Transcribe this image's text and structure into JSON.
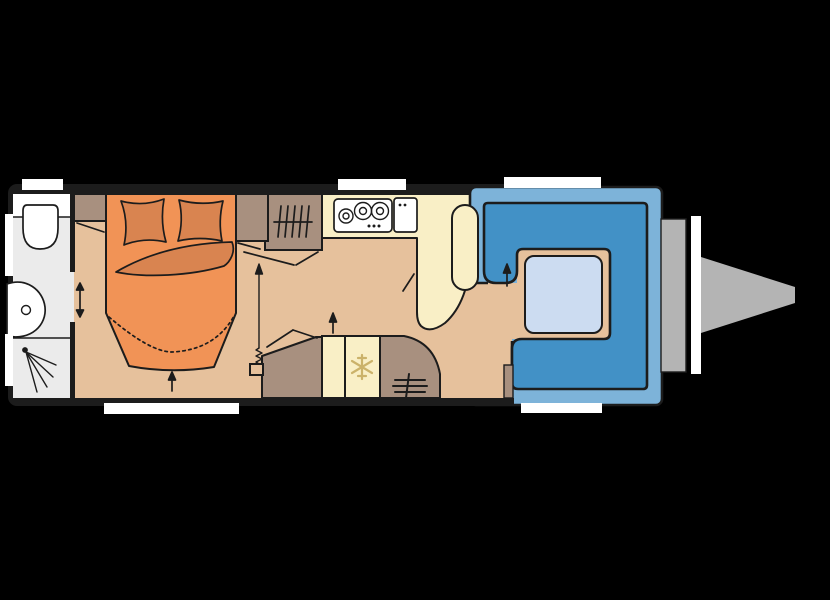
{
  "figure": {
    "type": "caravan-floorplan",
    "orientation": "hitch-right"
  },
  "colors": {
    "background": "#000000",
    "ink": "#1c1c1c",
    "white": "#ffffff",
    "floor": "#e6c19c",
    "bathroom": "#ebebeb",
    "bed": "#f19356",
    "bedding": "#d98450",
    "furniture": "#a8907f",
    "kitchen": "#f9efc6",
    "snowflake": "#cbb26a",
    "seat_outer": "#7db3d9",
    "seat_inner": "#4291c6",
    "table": "#ccdcf1",
    "hitch": "#b4b4b4"
  },
  "icons": {
    "toilet": "toilet-top-view",
    "washbasin": "basin-blob",
    "shower_spray": "corner-spray-lines",
    "clothes_rail": "rail-with-hanger-ticks",
    "stove": "three-burner-hob",
    "sink": "sink-with-two-taps",
    "fridge": "snowflake ❄",
    "heater": "heater-grille-lines",
    "door_direction": "arrow-up ↑",
    "sliding_door": "double-arrow ↕",
    "tv_mount": "pull-out-arrow"
  }
}
